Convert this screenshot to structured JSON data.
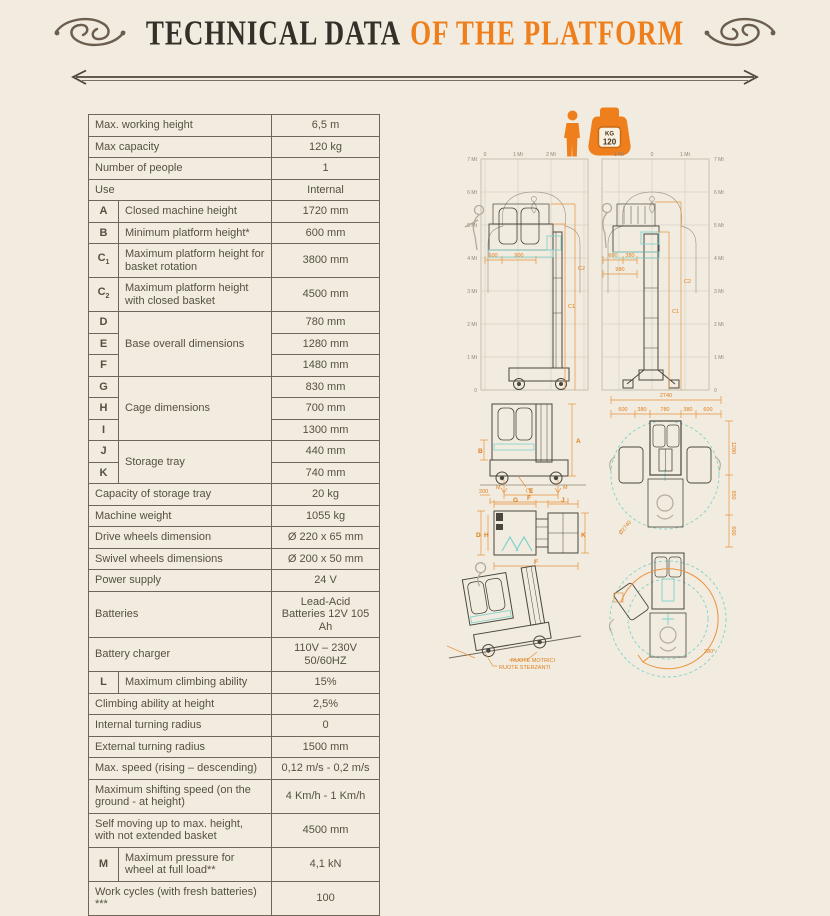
{
  "title": {
    "part_black": "TECHNICAL DATA",
    "part_orange": "OF THE PLATFORM"
  },
  "capacity_icons": {
    "weight_unit": "KG",
    "weight_value": "120"
  },
  "colors": {
    "accent_orange": "#ee7f1c",
    "dim_orange": "#e8923e",
    "ink": "#55503f",
    "table_border": "#6e6759",
    "cyan": "#7fd2cb",
    "background": "#f1ecdf"
  },
  "table": {
    "rows": [
      {
        "letter": null,
        "label": "Max. working height",
        "value": "6,5 m"
      },
      {
        "letter": null,
        "label": "Max capacity",
        "value": "120 kg"
      },
      {
        "letter": null,
        "label": "Number of people",
        "value": "1"
      },
      {
        "letter": null,
        "label": "Use",
        "value": "Internal"
      },
      {
        "letter": "A",
        "label": "Closed machine height",
        "value": "1720 mm"
      },
      {
        "letter": "B",
        "label": "Minimum platform height*",
        "value": "600 mm"
      },
      {
        "letter": "C1",
        "label": "Maximum platform height for basket rotation",
        "value": "3800 mm"
      },
      {
        "letter": "C2",
        "label": "Maximum platform height with closed basket",
        "value": "4500 mm"
      },
      {
        "letter": "D",
        "label": "Base overall dimensions",
        "label_rowspan": 3,
        "value": "780 mm"
      },
      {
        "letter": "E",
        "value": "1280 mm"
      },
      {
        "letter": "F",
        "value": "1480 mm"
      },
      {
        "letter": "G",
        "label": "Cage dimensions",
        "label_rowspan": 3,
        "value": "830 mm"
      },
      {
        "letter": "H",
        "value": "700 mm"
      },
      {
        "letter": "I",
        "value": "1300 mm"
      },
      {
        "letter": "J",
        "label": "Storage tray",
        "label_rowspan": 2,
        "value": "440 mm"
      },
      {
        "letter": "K",
        "value": "740 mm"
      },
      {
        "letter": null,
        "label": "Capacity of storage tray",
        "value": "20 kg"
      },
      {
        "letter": null,
        "label": "Machine weight",
        "value": "1055 kg"
      },
      {
        "letter": null,
        "label": "Drive wheels dimension",
        "value": "Ø 220 x 65 mm"
      },
      {
        "letter": null,
        "label": "Swivel wheels dimensions",
        "value": "Ø 200 x 50 mm"
      },
      {
        "letter": null,
        "label": "Power supply",
        "value": "24 V"
      },
      {
        "letter": null,
        "label": "Batteries",
        "value": "Lead-Acid Batteries 12V 105 Ah"
      },
      {
        "letter": null,
        "label": "Battery charger",
        "value": "110V – 230V 50/60HZ"
      },
      {
        "letter": "L",
        "label": "Maximum climbing ability",
        "value": "15%"
      },
      {
        "letter": null,
        "label": "Climbing ability at height",
        "value": "2,5%"
      },
      {
        "letter": null,
        "label": "Internal turning radius",
        "value": "0"
      },
      {
        "letter": null,
        "label": "External turning radius",
        "value": "1500 mm"
      },
      {
        "letter": null,
        "label": "Max. speed (rising – descending)",
        "value": "0,12 m/s - 0,2 m/s"
      },
      {
        "letter": null,
        "label": "Maximum shifting speed (on the ground - at height)",
        "value": "4 Km/h - 1 Km/h"
      },
      {
        "letter": null,
        "label": "Self moving up to max. height, with not extended basket",
        "value": "4500 mm"
      },
      {
        "letter": "M",
        "label": "Maximum pressure for wheel at full load**",
        "value": "4,1 kN"
      },
      {
        "letter": null,
        "label": "Work cycles (with fresh batteries) ***",
        "value": "100"
      }
    ]
  },
  "diagrams": {
    "elev_left": {
      "top_ticks": [
        "0",
        "1 Mt",
        "2 Mt"
      ],
      "yticks": [
        "7 Mt",
        "6 Mt",
        "5 Mt",
        "4 Mt",
        "3 Mt",
        "2 Mt",
        "1 Mt",
        "0"
      ],
      "dim_c2": "C2",
      "dim_c1": "C1",
      "dim_600": "600",
      "dim_900": "900"
    },
    "elev_right": {
      "top_ticks": [
        "1 Mt",
        "0",
        "1 Mt"
      ],
      "yticks": [
        "7 Mt",
        "6 Mt",
        "5 Mt",
        "4 Mt",
        "3 Mt",
        "2 Mt",
        "1 Mt",
        "0"
      ],
      "dim_c2": "C2",
      "dim_c1": "C1",
      "dim_600": "600",
      "dim_380": "380",
      "dim_980": "980"
    },
    "front_view": {
      "dim_a": "A",
      "dim_b": "B",
      "dim_m_left": "M",
      "dim_m_right": "M",
      "dim_star": "(*)",
      "dim_200": "200",
      "dim_e": "E",
      "dim_f": "F"
    },
    "base_view": {
      "dim_g": "G",
      "dim_j": "J",
      "dim_d": "D",
      "dim_h": "H",
      "dim_k": "K",
      "dim_f": "F"
    },
    "top_view": {
      "dim_total": "2740",
      "dim_600_left": "600",
      "dim_380_left": "380",
      "dim_780": "780",
      "dim_380_right": "380",
      "dim_600_right": "600",
      "dim_1280": "1280",
      "dim_950": "950",
      "dim_600_bottom": "600",
      "dim_diameter": "Ø2740"
    },
    "slope_view": {
      "label_drive_wheels": "RUOTE MOTRICI",
      "label_steering_wheels": "RUOTE STERZANTI"
    },
    "rotation_view": {
      "angle": "280°"
    }
  }
}
